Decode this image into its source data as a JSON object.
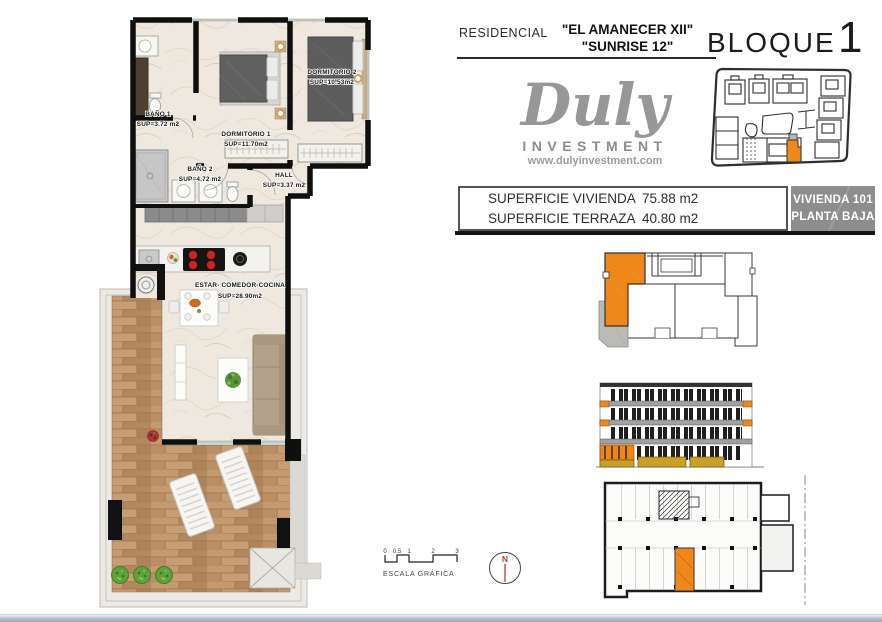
{
  "header": {
    "residencial_label": "RESIDENCIAL",
    "name_line1": "\"EL AMANECER XII\"",
    "name_line2": "\"SUNRISE 12\"",
    "bloque_label": "BLOQUE",
    "bloque_number": "1"
  },
  "logo": {
    "name": "Duly",
    "subtitle": "INVESTMENT",
    "website": "www.dulyinvestment.com"
  },
  "surface_table": {
    "rows": [
      {
        "label": "SUPERFICIE VIVIENDA",
        "value": "75.88 m2"
      },
      {
        "label": "SUPERFICIE TERRAZA",
        "value": "40.80 m2"
      }
    ]
  },
  "unit_badge": {
    "line1": "VIVIENDA 101",
    "line2": "PLANTA BAJA"
  },
  "floor_plan": {
    "rooms": [
      {
        "name": "BAÑO 1",
        "area": "SUP=3.72 m2"
      },
      {
        "name": "DORMITORIO 1",
        "area": "SUP=11.70m2"
      },
      {
        "name": "DORMITORIO 2",
        "area": "SUP=10.53m2"
      },
      {
        "name": "BAÑO 2",
        "area": "SUP=4.72 m2"
      },
      {
        "name": "HALL",
        "area": "SUP=3.37 m2"
      },
      {
        "name": "ESTAR- COMEDOR-COCINA",
        "area": "SUP=28.90m2"
      }
    ]
  },
  "scale_bar": {
    "ticks": [
      "0",
      "0.5",
      "1",
      "2",
      "3"
    ],
    "label": "ESCALA GRÁFICA"
  },
  "north_arrow": {
    "letter": "N"
  },
  "colors": {
    "accent_orange": "#F0871A",
    "badge_gray": "#8D8D8D",
    "base_ochre": "#C9A127",
    "logo_gray": "#979797"
  }
}
